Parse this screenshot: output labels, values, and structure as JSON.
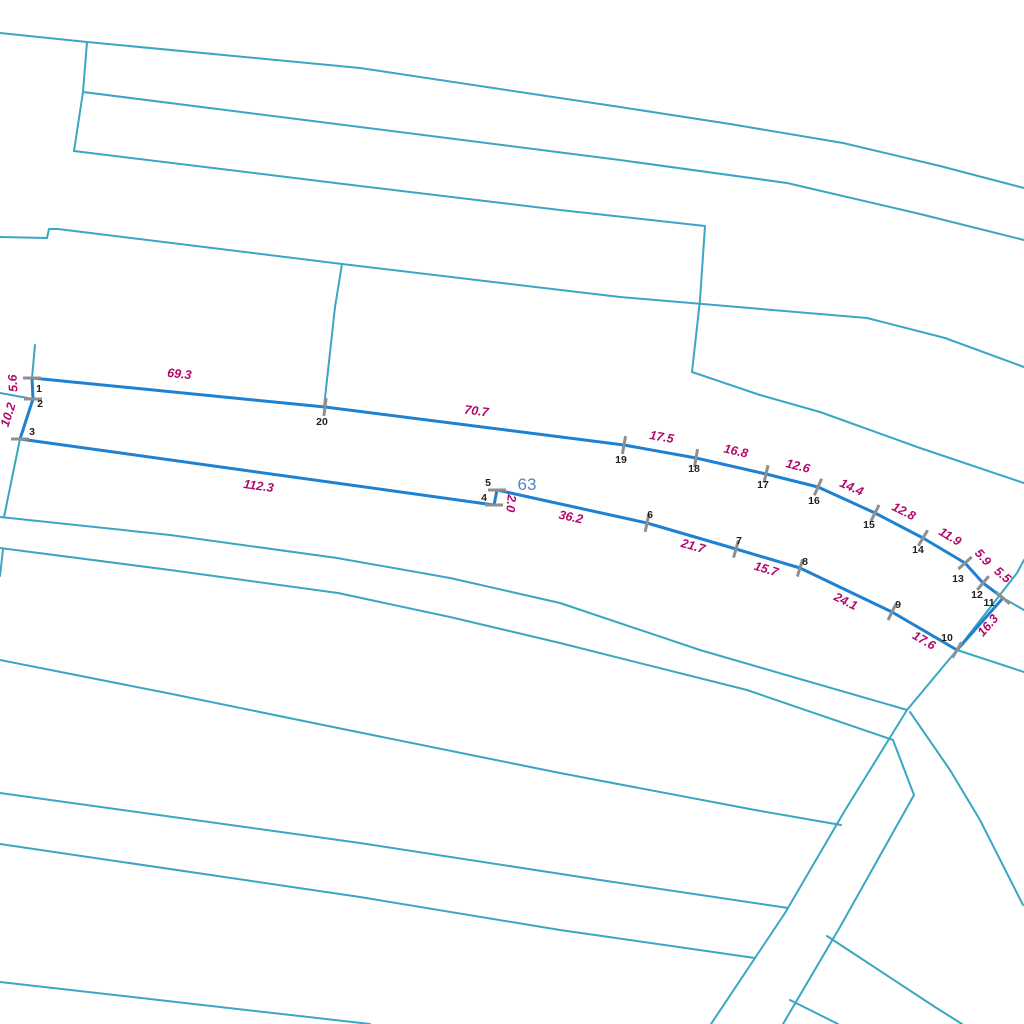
{
  "map": {
    "background_color": "#ffffff",
    "boundary_line_color": "#3ba6c4",
    "boundary_line_width": 2,
    "selected_parcel": {
      "outline_color": "#1e81d2",
      "outline_width": 3,
      "parcel_number": {
        "text": "63",
        "x": 527,
        "y": 490,
        "color": "#4d87c4"
      },
      "vertex_number_color": "#1f1f1f",
      "edge_label_color": "#b2096b",
      "tick_color": "#8f8f8f",
      "tick_half_length": 9,
      "vertices": [
        {
          "n": "1",
          "x": 32,
          "y": 378,
          "lx": 39,
          "ly": 389,
          "tick": 0
        },
        {
          "n": "2",
          "x": 33,
          "y": 399,
          "lx": 40,
          "ly": 404,
          "tick": 0
        },
        {
          "n": "3",
          "x": 20,
          "y": 439,
          "lx": 32,
          "ly": 432,
          "tick": 0
        },
        {
          "n": "4",
          "x": 494,
          "y": 505,
          "lx": 484,
          "ly": 498,
          "tick": 0
        },
        {
          "n": "5",
          "x": 497,
          "y": 490,
          "lx": 488,
          "ly": 483,
          "tick": 0
        },
        {
          "n": "6",
          "x": 647,
          "y": 523,
          "lx": 650,
          "ly": 515,
          "tick": 102
        },
        {
          "n": "7",
          "x": 736,
          "y": 549,
          "lx": 739,
          "ly": 541,
          "tick": 106
        },
        {
          "n": "8",
          "x": 800,
          "y": 568,
          "lx": 805,
          "ly": 562,
          "tick": 107
        },
        {
          "n": "9",
          "x": 892,
          "y": 612,
          "lx": 898,
          "ly": 605,
          "tick": 116
        },
        {
          "n": "10",
          "x": 957,
          "y": 650,
          "lx": 947,
          "ly": 638,
          "tick": 120
        },
        {
          "n": "11",
          "x": 1003,
          "y": 598,
          "lx": 989,
          "ly": 603,
          "tick": 41
        },
        {
          "n": "12",
          "x": 983,
          "y": 583,
          "lx": 977,
          "ly": 595,
          "tick": 130
        },
        {
          "n": "13",
          "x": 965,
          "y": 563,
          "lx": 958,
          "ly": 579,
          "tick": 138
        },
        {
          "n": "14",
          "x": 923,
          "y": 538,
          "lx": 918,
          "ly": 550,
          "tick": 121
        },
        {
          "n": "15",
          "x": 875,
          "y": 513,
          "lx": 869,
          "ly": 525,
          "tick": 117
        },
        {
          "n": "16",
          "x": 818,
          "y": 487,
          "lx": 814,
          "ly": 501,
          "tick": 114
        },
        {
          "n": "17",
          "x": 766,
          "y": 474,
          "lx": 763,
          "ly": 485,
          "tick": 103
        },
        {
          "n": "18",
          "x": 696,
          "y": 458,
          "lx": 694,
          "ly": 469,
          "tick": 100
        },
        {
          "n": "19",
          "x": 624,
          "y": 445,
          "lx": 621,
          "ly": 460,
          "tick": 100
        },
        {
          "n": "20",
          "x": 325,
          "y": 407,
          "lx": 322,
          "ly": 422,
          "tick": 97
        }
      ],
      "edge_labels": [
        {
          "text": "5.6",
          "x": 17,
          "y": 383,
          "rot": -93
        },
        {
          "text": "10.2",
          "x": 12,
          "y": 416,
          "rot": -72
        },
        {
          "text": "112.3",
          "x": 258,
          "y": 490,
          "rot": 8
        },
        {
          "text": "2.0",
          "x": 507,
          "y": 503,
          "rot": 96
        },
        {
          "text": "36.2",
          "x": 570,
          "y": 521,
          "rot": 12
        },
        {
          "text": "21.7",
          "x": 692,
          "y": 550,
          "rot": 16
        },
        {
          "text": "15.7",
          "x": 765,
          "y": 573,
          "rot": 17
        },
        {
          "text": "24.1",
          "x": 844,
          "y": 605,
          "rot": 26
        },
        {
          "text": "17.6",
          "x": 922,
          "y": 644,
          "rot": 30
        },
        {
          "text": "16.3",
          "x": 991,
          "y": 628,
          "rot": -49
        },
        {
          "text": "5.5",
          "x": 1000,
          "y": 578,
          "rot": 40
        },
        {
          "text": "5.9",
          "x": 980,
          "y": 560,
          "rot": 48
        },
        {
          "text": "11.9",
          "x": 948,
          "y": 540,
          "rot": 31
        },
        {
          "text": "12.8",
          "x": 902,
          "y": 515,
          "rot": 27
        },
        {
          "text": "14.4",
          "x": 850,
          "y": 491,
          "rot": 24
        },
        {
          "text": "12.6",
          "x": 797,
          "y": 470,
          "rot": 14
        },
        {
          "text": "16.8",
          "x": 735,
          "y": 455,
          "rot": 13
        },
        {
          "text": "17.5",
          "x": 661,
          "y": 441,
          "rot": 10
        },
        {
          "text": "70.7",
          "x": 476,
          "y": 415,
          "rot": 7
        },
        {
          "text": "69.3",
          "x": 179,
          "y": 378,
          "rot": 6
        }
      ]
    },
    "background_lines": [
      {
        "name": "boundary-top-a",
        "points": [
          [
            0,
            33
          ],
          [
            87,
            42
          ],
          [
            360,
            68
          ],
          [
            620,
            107
          ],
          [
            730,
            124
          ],
          [
            843,
            143
          ],
          [
            940,
            166
          ],
          [
            1024,
            188
          ]
        ]
      },
      {
        "name": "boundary-top-b",
        "points": [
          [
            83,
            92
          ],
          [
            360,
            127
          ],
          [
            620,
            160
          ],
          [
            787,
            183
          ],
          [
            920,
            214
          ],
          [
            1024,
            240
          ]
        ]
      },
      {
        "name": "connector-top-left",
        "points": [
          [
            87,
            42
          ],
          [
            83,
            92
          ],
          [
            74,
            151
          ]
        ]
      },
      {
        "name": "boundary-top-c",
        "points": [
          [
            74,
            151
          ],
          [
            360,
            186
          ],
          [
            560,
            210
          ],
          [
            705,
            226
          ],
          [
            700,
            300
          ],
          [
            692,
            372
          ]
        ]
      },
      {
        "name": "boundary-stepped",
        "points": [
          [
            0,
            237
          ],
          [
            47,
            238
          ],
          [
            49,
            229
          ],
          [
            58,
            229
          ],
          [
            342,
            264
          ],
          [
            620,
            297
          ],
          [
            867,
            318
          ],
          [
            945,
            338
          ],
          [
            1024,
            367
          ]
        ]
      },
      {
        "name": "boundary-mid-right",
        "points": [
          [
            692,
            372
          ],
          [
            760,
            395
          ],
          [
            820,
            412
          ],
          [
            920,
            448
          ],
          [
            1024,
            483
          ]
        ]
      },
      {
        "name": "connector-to-v20",
        "points": [
          [
            342,
            264
          ],
          [
            335,
            307
          ],
          [
            324,
            407
          ]
        ]
      },
      {
        "name": "connector-left-v123",
        "points": [
          [
            35,
            345
          ],
          [
            32,
            378
          ],
          [
            33,
            399
          ],
          [
            20,
            439
          ],
          [
            4,
            517
          ]
        ]
      },
      {
        "name": "stub-left-v2",
        "points": [
          [
            0,
            393
          ],
          [
            33,
            399
          ]
        ]
      },
      {
        "name": "stub-left-lower",
        "points": [
          [
            3,
            549
          ],
          [
            0,
            576
          ]
        ]
      },
      {
        "name": "road-upper-edge",
        "points": [
          [
            0,
            517
          ],
          [
            170,
            535
          ],
          [
            337,
            558
          ],
          [
            450,
            578
          ],
          [
            560,
            603
          ],
          [
            700,
            650
          ],
          [
            793,
            677
          ],
          [
            897,
            707
          ],
          [
            907,
            710
          ],
          [
            844,
            812
          ],
          [
            785,
            913
          ],
          [
            711,
            1024
          ]
        ]
      },
      {
        "name": "road-lower-edge",
        "points": [
          [
            0,
            548
          ],
          [
            170,
            570
          ],
          [
            338,
            593
          ],
          [
            450,
            617
          ],
          [
            560,
            643
          ],
          [
            747,
            690
          ],
          [
            893,
            740
          ],
          [
            914,
            795
          ],
          [
            840,
            927
          ],
          [
            783,
            1024
          ]
        ]
      },
      {
        "name": "road-branch-right-a",
        "points": [
          [
            910,
            712
          ],
          [
            950,
            770
          ],
          [
            980,
            820
          ],
          [
            1023,
            905
          ]
        ]
      },
      {
        "name": "road-branch-right-b",
        "points": [
          [
            827,
            936
          ],
          [
            935,
            1007
          ],
          [
            962,
            1024
          ]
        ]
      },
      {
        "name": "road-branch-right-c",
        "points": [
          [
            790,
            1000
          ],
          [
            838,
            1024
          ]
        ]
      },
      {
        "name": "field-line-a",
        "points": [
          [
            0,
            660
          ],
          [
            167,
            693
          ],
          [
            333,
            727
          ],
          [
            560,
            773
          ],
          [
            755,
            810
          ],
          [
            841,
            825
          ]
        ]
      },
      {
        "name": "field-line-b",
        "points": [
          [
            0,
            793
          ],
          [
            360,
            843
          ],
          [
            600,
            880
          ],
          [
            788,
            908
          ]
        ]
      },
      {
        "name": "field-line-c",
        "points": [
          [
            0,
            844
          ],
          [
            360,
            897
          ],
          [
            560,
            930
          ],
          [
            755,
            958
          ]
        ]
      },
      {
        "name": "field-line-d",
        "points": [
          [
            0,
            982
          ],
          [
            370,
            1024
          ]
        ]
      },
      {
        "name": "spur-through-v10",
        "points": [
          [
            907,
            710
          ],
          [
            957,
            650
          ],
          [
            1017,
            573
          ],
          [
            1024,
            560
          ]
        ]
      },
      {
        "name": "spur-v10-right",
        "points": [
          [
            957,
            650
          ],
          [
            1024,
            672
          ]
        ]
      },
      {
        "name": "spur-v11-right",
        "points": [
          [
            1003,
            598
          ],
          [
            1024,
            610
          ]
        ]
      }
    ]
  }
}
